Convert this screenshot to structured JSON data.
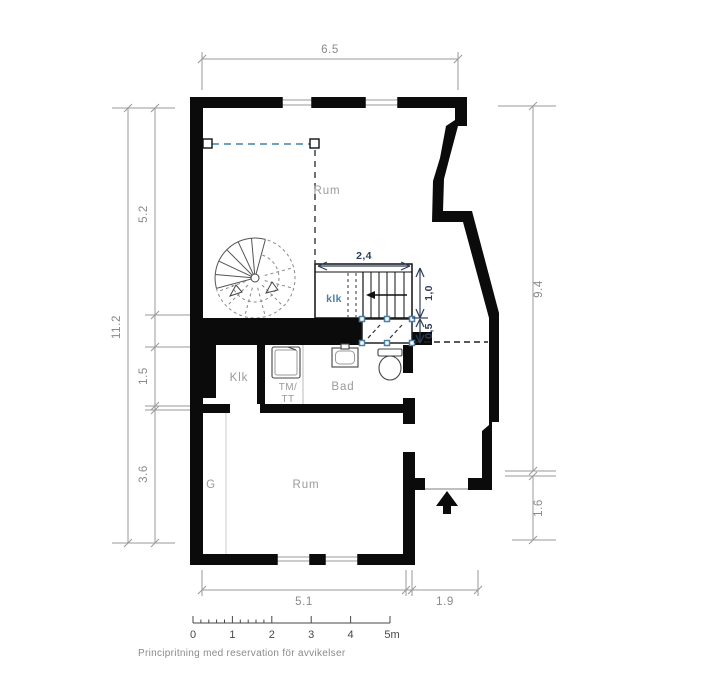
{
  "dimensions": {
    "top_width": "6.5",
    "left_total": "11.2",
    "left_upper": "5.2",
    "left_middle": "1.5",
    "left_lower": "3.6",
    "right_main": "9.4",
    "right_entry": "1.6",
    "bottom_main": "5.1",
    "bottom_entry": "1.9"
  },
  "stair_dimensions": {
    "width": "2,4",
    "run": "1,0",
    "landing": "0,5"
  },
  "rooms": {
    "room_upper": "Rum",
    "closet_under_stairs": "klk",
    "closet": "Klk",
    "laundry_line1": "TM/",
    "laundry_line2": "TT",
    "bathroom": "Bad",
    "wardrobe": "G",
    "room_lower": "Rum"
  },
  "scale_bar": {
    "labels": [
      "0",
      "1",
      "2",
      "3",
      "4",
      "5m"
    ]
  },
  "footer": {
    "disclaimer": "Principritning med reservation för avvikelser"
  },
  "colors": {
    "wall": "#0b0b0b",
    "dimension_gray": "#8a8a8a",
    "dashed_blue": "#4182ad",
    "marker_blue": "#4a7fa6",
    "stair_dim_navy": "#2e3f5c",
    "scale_text": "#474747"
  }
}
